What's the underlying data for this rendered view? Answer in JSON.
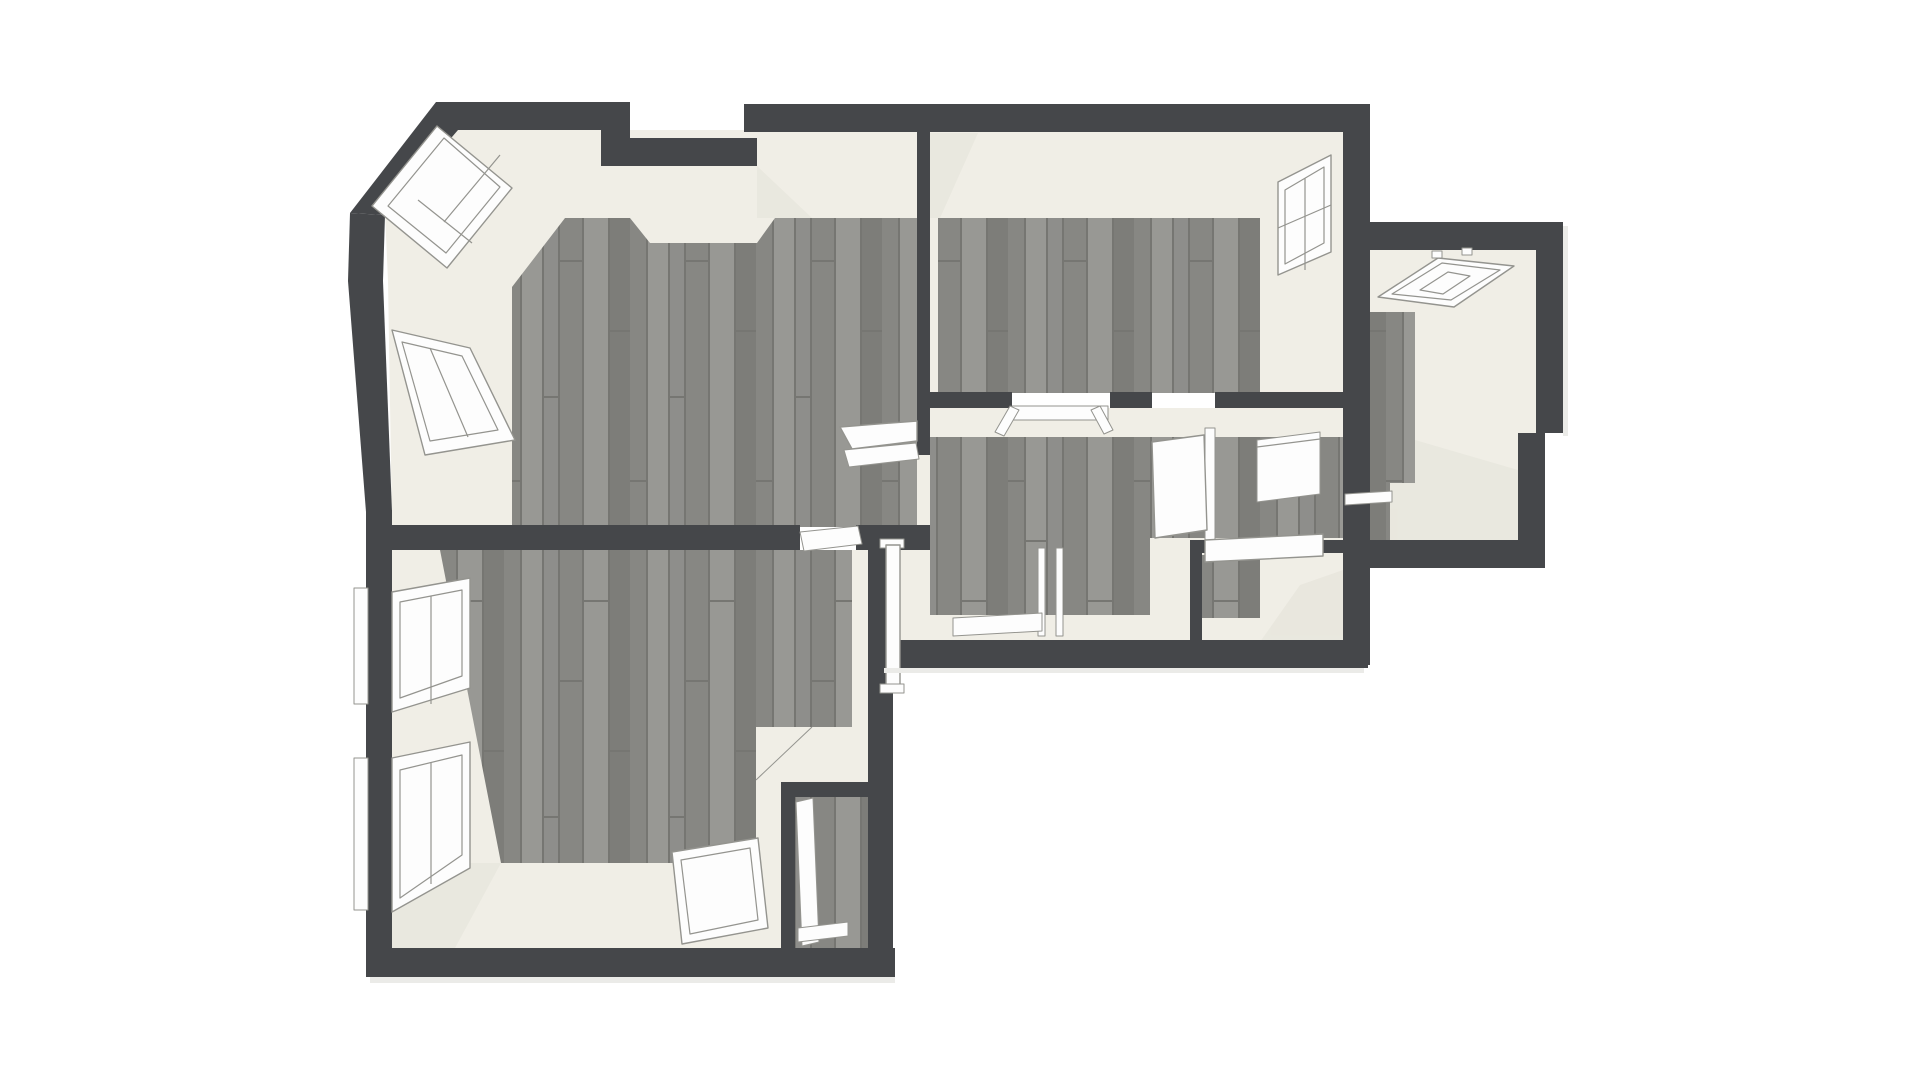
{
  "palette": {
    "background": "#ffffff",
    "wall": "#45474a",
    "cream": "#f0eee6",
    "cream_shade": "#e7e5dc",
    "white": "#fdfdfd",
    "frame_line": "#94948f",
    "shadow": "#ebebe8",
    "floor_base": "#8e8e8b",
    "floor_light": "#989894",
    "floor_mid": "#878783",
    "floor_dark": "#7d7d79",
    "floor_line": "#767672"
  },
  "scene": {
    "view": "3d-floor-plan-top-down",
    "rooms": [
      "room-top-left-living",
      "room-top-right-bedroom",
      "room-hallway",
      "room-vestibule",
      "room-bathroom",
      "room-far-right-attic",
      "room-bottom-left-bedroom",
      "closet-niche"
    ],
    "windows": [
      "bay-window-upper",
      "bay-window-lower",
      "west-window-upper",
      "west-window-lower",
      "east-window-top-right",
      "skylight-far-right"
    ],
    "doors": [
      "threshold-living-south",
      "threshold-hallway-north",
      "open-door-leaf-hallway",
      "open-door-leaf-living",
      "open-door-leaf-vestibule",
      "threshold-far-right",
      "interior-window-bathroom",
      "door-frame-vestibule",
      "loose-door-panel-floor",
      "leaning-panel-niche"
    ]
  }
}
